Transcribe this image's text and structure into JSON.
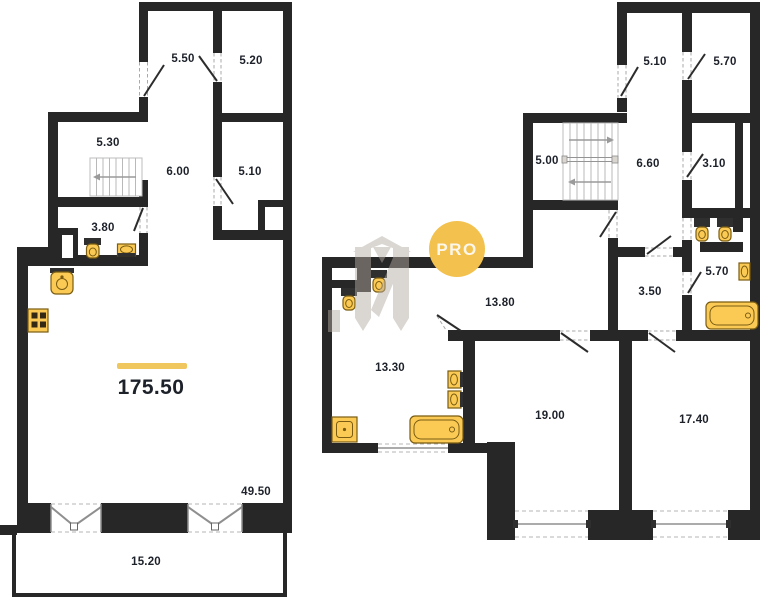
{
  "colors": {
    "wall": "#272727",
    "door": "#2c2c2c",
    "fixture": "#fbca55",
    "fixture_stroke": "#7a5c12",
    "accent_bar": "#f0c75e",
    "label_text": "#1d212a",
    "window_line": "#8f8f8f",
    "watermark_grey": "#b3aaa1",
    "watermark_circle": "#f2c14e",
    "watermark_text": "#fcf7ea"
  },
  "watermark": {
    "text": "PRO"
  },
  "left_plan": {
    "name": "level with living-kitchen",
    "total_area": "175.50",
    "living_area": "49.50",
    "balcony_area": "15.20",
    "rooms": [
      {
        "area": "5.50"
      },
      {
        "area": "5.20"
      },
      {
        "area": "5.30"
      },
      {
        "area": "6.00"
      },
      {
        "area": "5.10"
      },
      {
        "area": "3.80"
      }
    ]
  },
  "right_plan": {
    "name": "level with bedrooms",
    "rooms": [
      {
        "area": "5.10"
      },
      {
        "area": "5.70"
      },
      {
        "area": "5.00"
      },
      {
        "area": "6.60"
      },
      {
        "area": "3.10"
      },
      {
        "area": "3.50"
      },
      {
        "area": "5.70"
      },
      {
        "area": "13.80"
      },
      {
        "area": "13.30"
      },
      {
        "area": "19.00"
      },
      {
        "area": "17.40"
      }
    ]
  }
}
